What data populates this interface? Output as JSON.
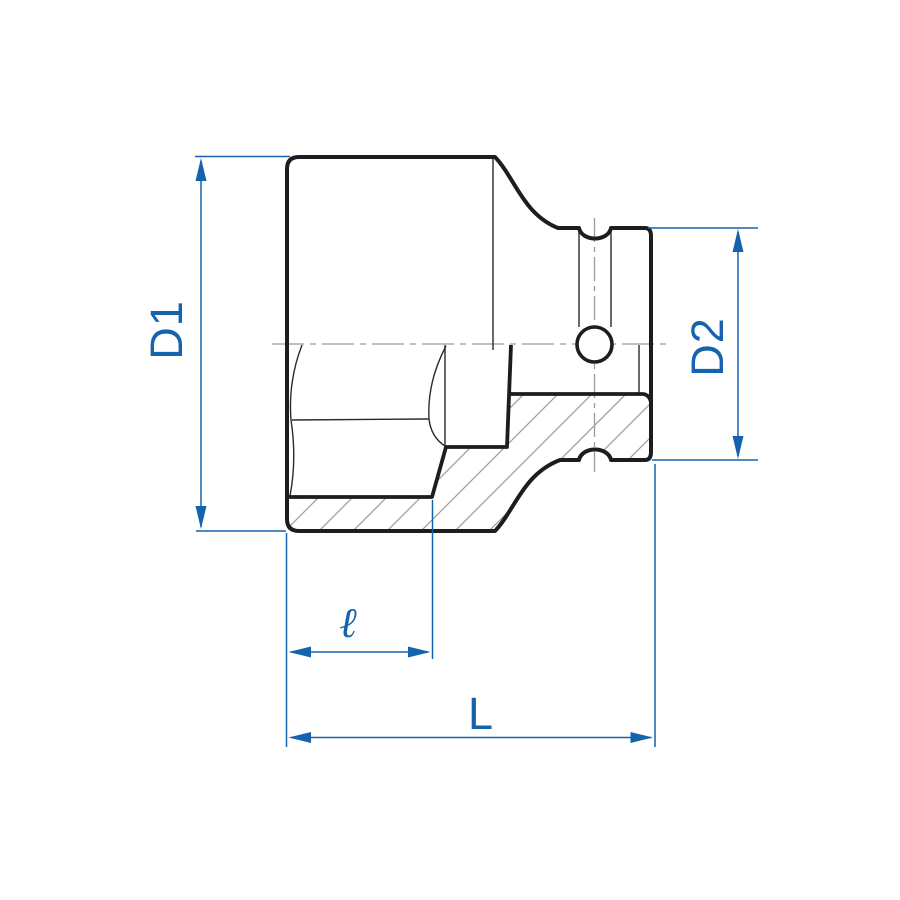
{
  "diagram": {
    "type": "technical-drawing",
    "subject": "impact-socket-cross-section",
    "labels": {
      "d1": "D1",
      "d2": "D2",
      "ell": "ℓ",
      "length": "L"
    },
    "colors": {
      "dimension_blue": "#1463ac",
      "outline_black": "#1d1d1f",
      "thin_line_dark": "#2b2b2d",
      "centerline_gray": "#9b9b9b",
      "hatch_gray": "#9b9b9b",
      "background": "#ffffff"
    }
  }
}
